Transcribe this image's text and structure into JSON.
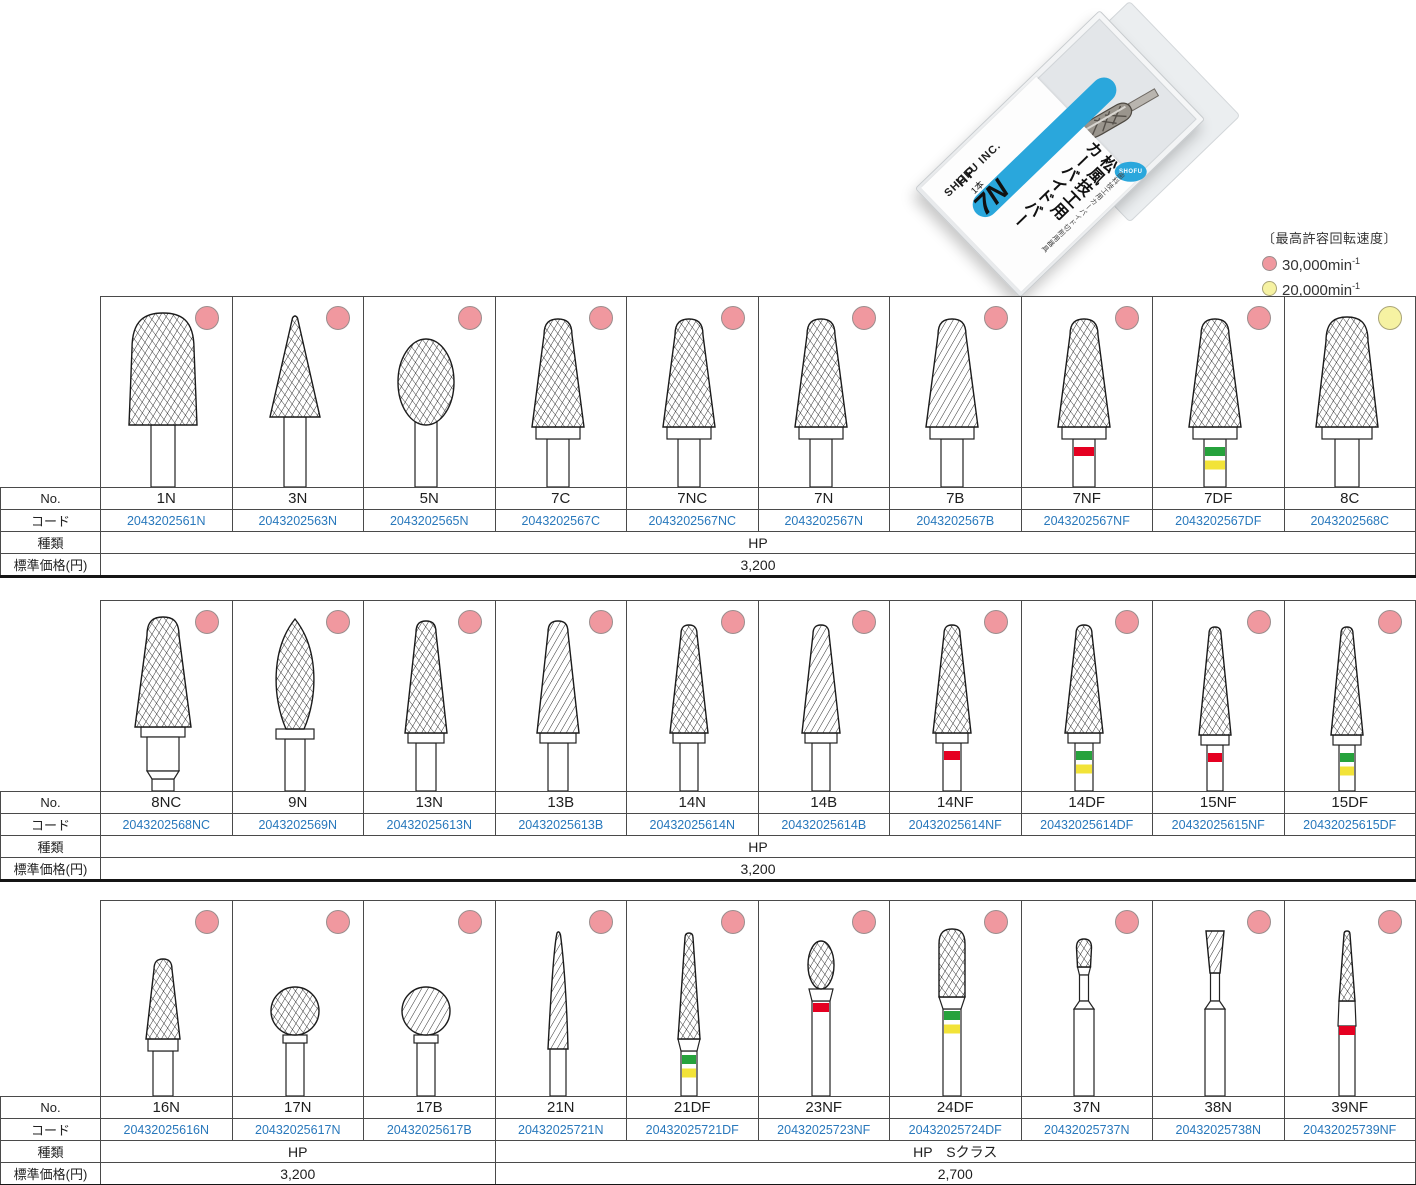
{
  "legend": {
    "title": "〔最高許容回転速度〕",
    "items": [
      {
        "color": "pink",
        "label": "30,000min",
        "exp": "-1"
      },
      {
        "color": "yellow",
        "label": "20,000min",
        "exp": "-1"
      }
    ]
  },
  "package": {
    "small_text": "歯科技工用カーバイド切削用器具",
    "title_line1": "松風技工用",
    "title_line2": "カーバイドバー",
    "size_label": "7N",
    "type_label": "HP",
    "count_label": "1本",
    "brand": "SHOFU INC.",
    "logo_text": "SHOFU"
  },
  "row_labels": {
    "no": "No.",
    "code": "コード",
    "kind": "種類",
    "price": "標準価格(円)"
  },
  "colors": {
    "pink_dot": "#f0989f",
    "yellow_dot": "#f6f2a2",
    "code_text": "#2878bc",
    "band_red": "#e50021",
    "band_green": "#26a23c",
    "band_yellow": "#f2e338",
    "accent_blue": "#2aa7dc"
  },
  "tables": [
    {
      "items": [
        {
          "no": "1N",
          "code": "2043202561N",
          "dot": "pink",
          "shape": "cylinder-round",
          "bands": []
        },
        {
          "no": "3N",
          "code": "2043202563N",
          "dot": "pink",
          "shape": "cone",
          "bands": []
        },
        {
          "no": "5N",
          "code": "2043202565N",
          "dot": "pink",
          "shape": "egg",
          "bands": []
        },
        {
          "no": "7C",
          "code": "2043202567C",
          "dot": "pink",
          "shape": "taper-round",
          "bands": []
        },
        {
          "no": "7NC",
          "code": "2043202567NC",
          "dot": "pink",
          "shape": "taper-round",
          "bands": []
        },
        {
          "no": "7N",
          "code": "2043202567N",
          "dot": "pink",
          "shape": "taper-round",
          "bands": []
        },
        {
          "no": "7B",
          "code": "2043202567B",
          "dot": "pink",
          "shape": "taper-round-plain",
          "bands": []
        },
        {
          "no": "7NF",
          "code": "2043202567NF",
          "dot": "pink",
          "shape": "taper-round",
          "bands": [
            "red"
          ]
        },
        {
          "no": "7DF",
          "code": "2043202567DF",
          "dot": "pink",
          "shape": "taper-round",
          "bands": [
            "green",
            "yellow"
          ]
        },
        {
          "no": "8C",
          "code": "2043202568C",
          "dot": "yellow",
          "shape": "taper-round-wide",
          "bands": []
        }
      ],
      "kind_spans": [
        {
          "span": 10,
          "label": "HP"
        }
      ],
      "price_spans": [
        {
          "span": 10,
          "label": "3,200"
        }
      ]
    },
    {
      "items": [
        {
          "no": "8NC",
          "code": "2043202568NC",
          "dot": "pink",
          "shape": "taper-round-step",
          "bands": []
        },
        {
          "no": "9N",
          "code": "2043202569N",
          "dot": "pink",
          "shape": "flame",
          "bands": []
        },
        {
          "no": "13N",
          "code": "20432025613N",
          "dot": "pink",
          "shape": "taper-slim",
          "bands": []
        },
        {
          "no": "13B",
          "code": "20432025613B",
          "dot": "pink",
          "shape": "taper-slim-plain",
          "bands": []
        },
        {
          "no": "14N",
          "code": "20432025614N",
          "dot": "pink",
          "shape": "taper-slim2",
          "bands": []
        },
        {
          "no": "14B",
          "code": "20432025614B",
          "dot": "pink",
          "shape": "taper-slim2-plain",
          "bands": []
        },
        {
          "no": "14NF",
          "code": "20432025614NF",
          "dot": "pink",
          "shape": "taper-slim2",
          "bands": [
            "red"
          ]
        },
        {
          "no": "14DF",
          "code": "20432025614DF",
          "dot": "pink",
          "shape": "taper-slim2",
          "bands": [
            "green",
            "yellow"
          ]
        },
        {
          "no": "15NF",
          "code": "20432025615NF",
          "dot": "pink",
          "shape": "taper-xslim",
          "bands": [
            "red"
          ]
        },
        {
          "no": "15DF",
          "code": "20432025615DF",
          "dot": "pink",
          "shape": "taper-xslim",
          "bands": [
            "green",
            "yellow"
          ]
        }
      ],
      "kind_spans": [
        {
          "span": 10,
          "label": "HP"
        }
      ],
      "price_spans": [
        {
          "span": 10,
          "label": "3,200"
        }
      ]
    },
    {
      "items": [
        {
          "no": "16N",
          "code": "20432025616N",
          "dot": "pink",
          "shape": "taper-small",
          "bands": []
        },
        {
          "no": "17N",
          "code": "20432025617N",
          "dot": "pink",
          "shape": "ball",
          "bands": []
        },
        {
          "no": "17B",
          "code": "20432025617B",
          "dot": "pink",
          "shape": "ball-plain",
          "bands": []
        },
        {
          "no": "21N",
          "code": "20432025721N",
          "dot": "pink",
          "shape": "needle",
          "bands": []
        },
        {
          "no": "21DF",
          "code": "20432025721DF",
          "dot": "pink",
          "shape": "needle-fine",
          "bands": [
            "green",
            "yellow"
          ]
        },
        {
          "no": "23NF",
          "code": "20432025723NF",
          "dot": "pink",
          "shape": "egg-small",
          "bands": [
            "red"
          ]
        },
        {
          "no": "24DF",
          "code": "20432025724DF",
          "dot": "pink",
          "shape": "cylinder-small",
          "bands": [
            "green",
            "yellow"
          ]
        },
        {
          "no": "37N",
          "code": "20432025737N",
          "dot": "pink",
          "shape": "pear-tiny",
          "bands": []
        },
        {
          "no": "38N",
          "code": "20432025738N",
          "dot": "pink",
          "shape": "invcone-tiny",
          "bands": []
        },
        {
          "no": "39NF",
          "code": "20432025739NF",
          "dot": "pink",
          "shape": "taper-thin",
          "bands": [
            "red"
          ]
        }
      ],
      "kind_spans": [
        {
          "span": 3,
          "label": "HP"
        },
        {
          "span": 7,
          "label": "HP　Sクラス"
        }
      ],
      "price_spans": [
        {
          "span": 3,
          "label": "3,200"
        },
        {
          "span": 7,
          "label": "2,700"
        }
      ]
    }
  ]
}
